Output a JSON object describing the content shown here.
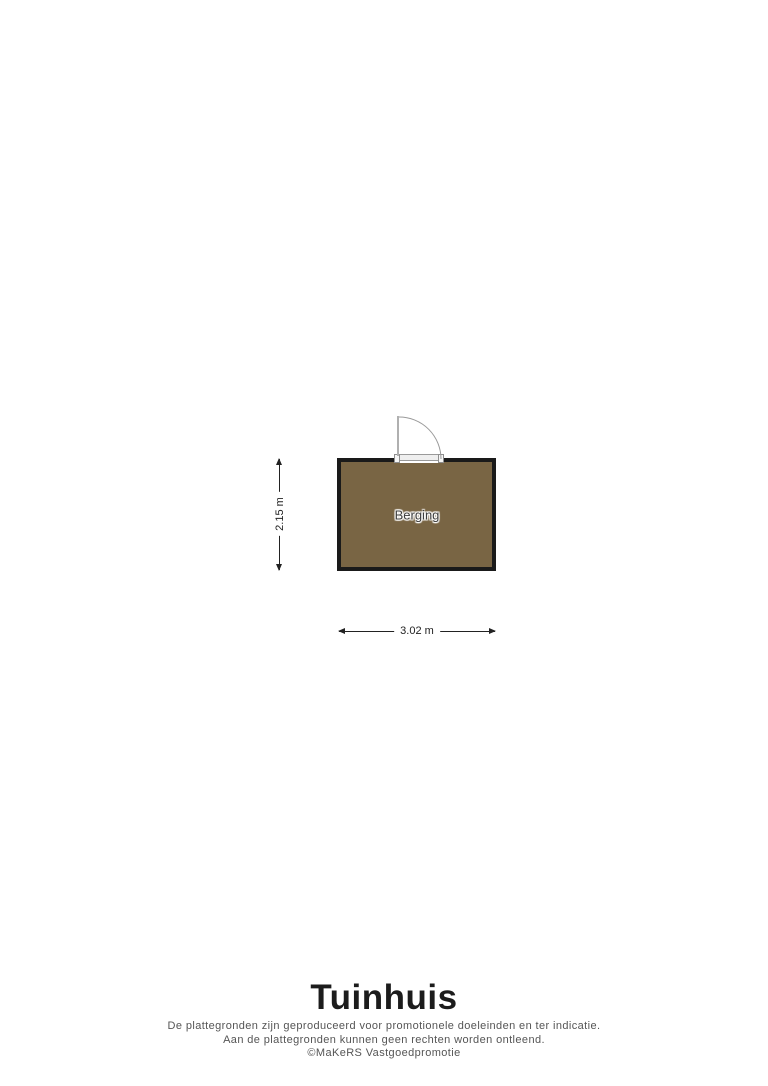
{
  "floorplan": {
    "room": {
      "label": "Berging",
      "fill_color": "#796544",
      "wall_color": "#1a1a1a"
    },
    "dimensions": {
      "height_label": "2.15 m",
      "width_label": "3.02 m"
    },
    "title": "Tuinhuis",
    "disclaimer": {
      "line1": "De plattegronden zijn geproduceerd voor promotionele doeleinden en ter indicatie.",
      "line2": "Aan de plattegronden kunnen geen rechten worden ontleend.",
      "line3": "©MaKeRS Vastgoedpromotie"
    }
  }
}
